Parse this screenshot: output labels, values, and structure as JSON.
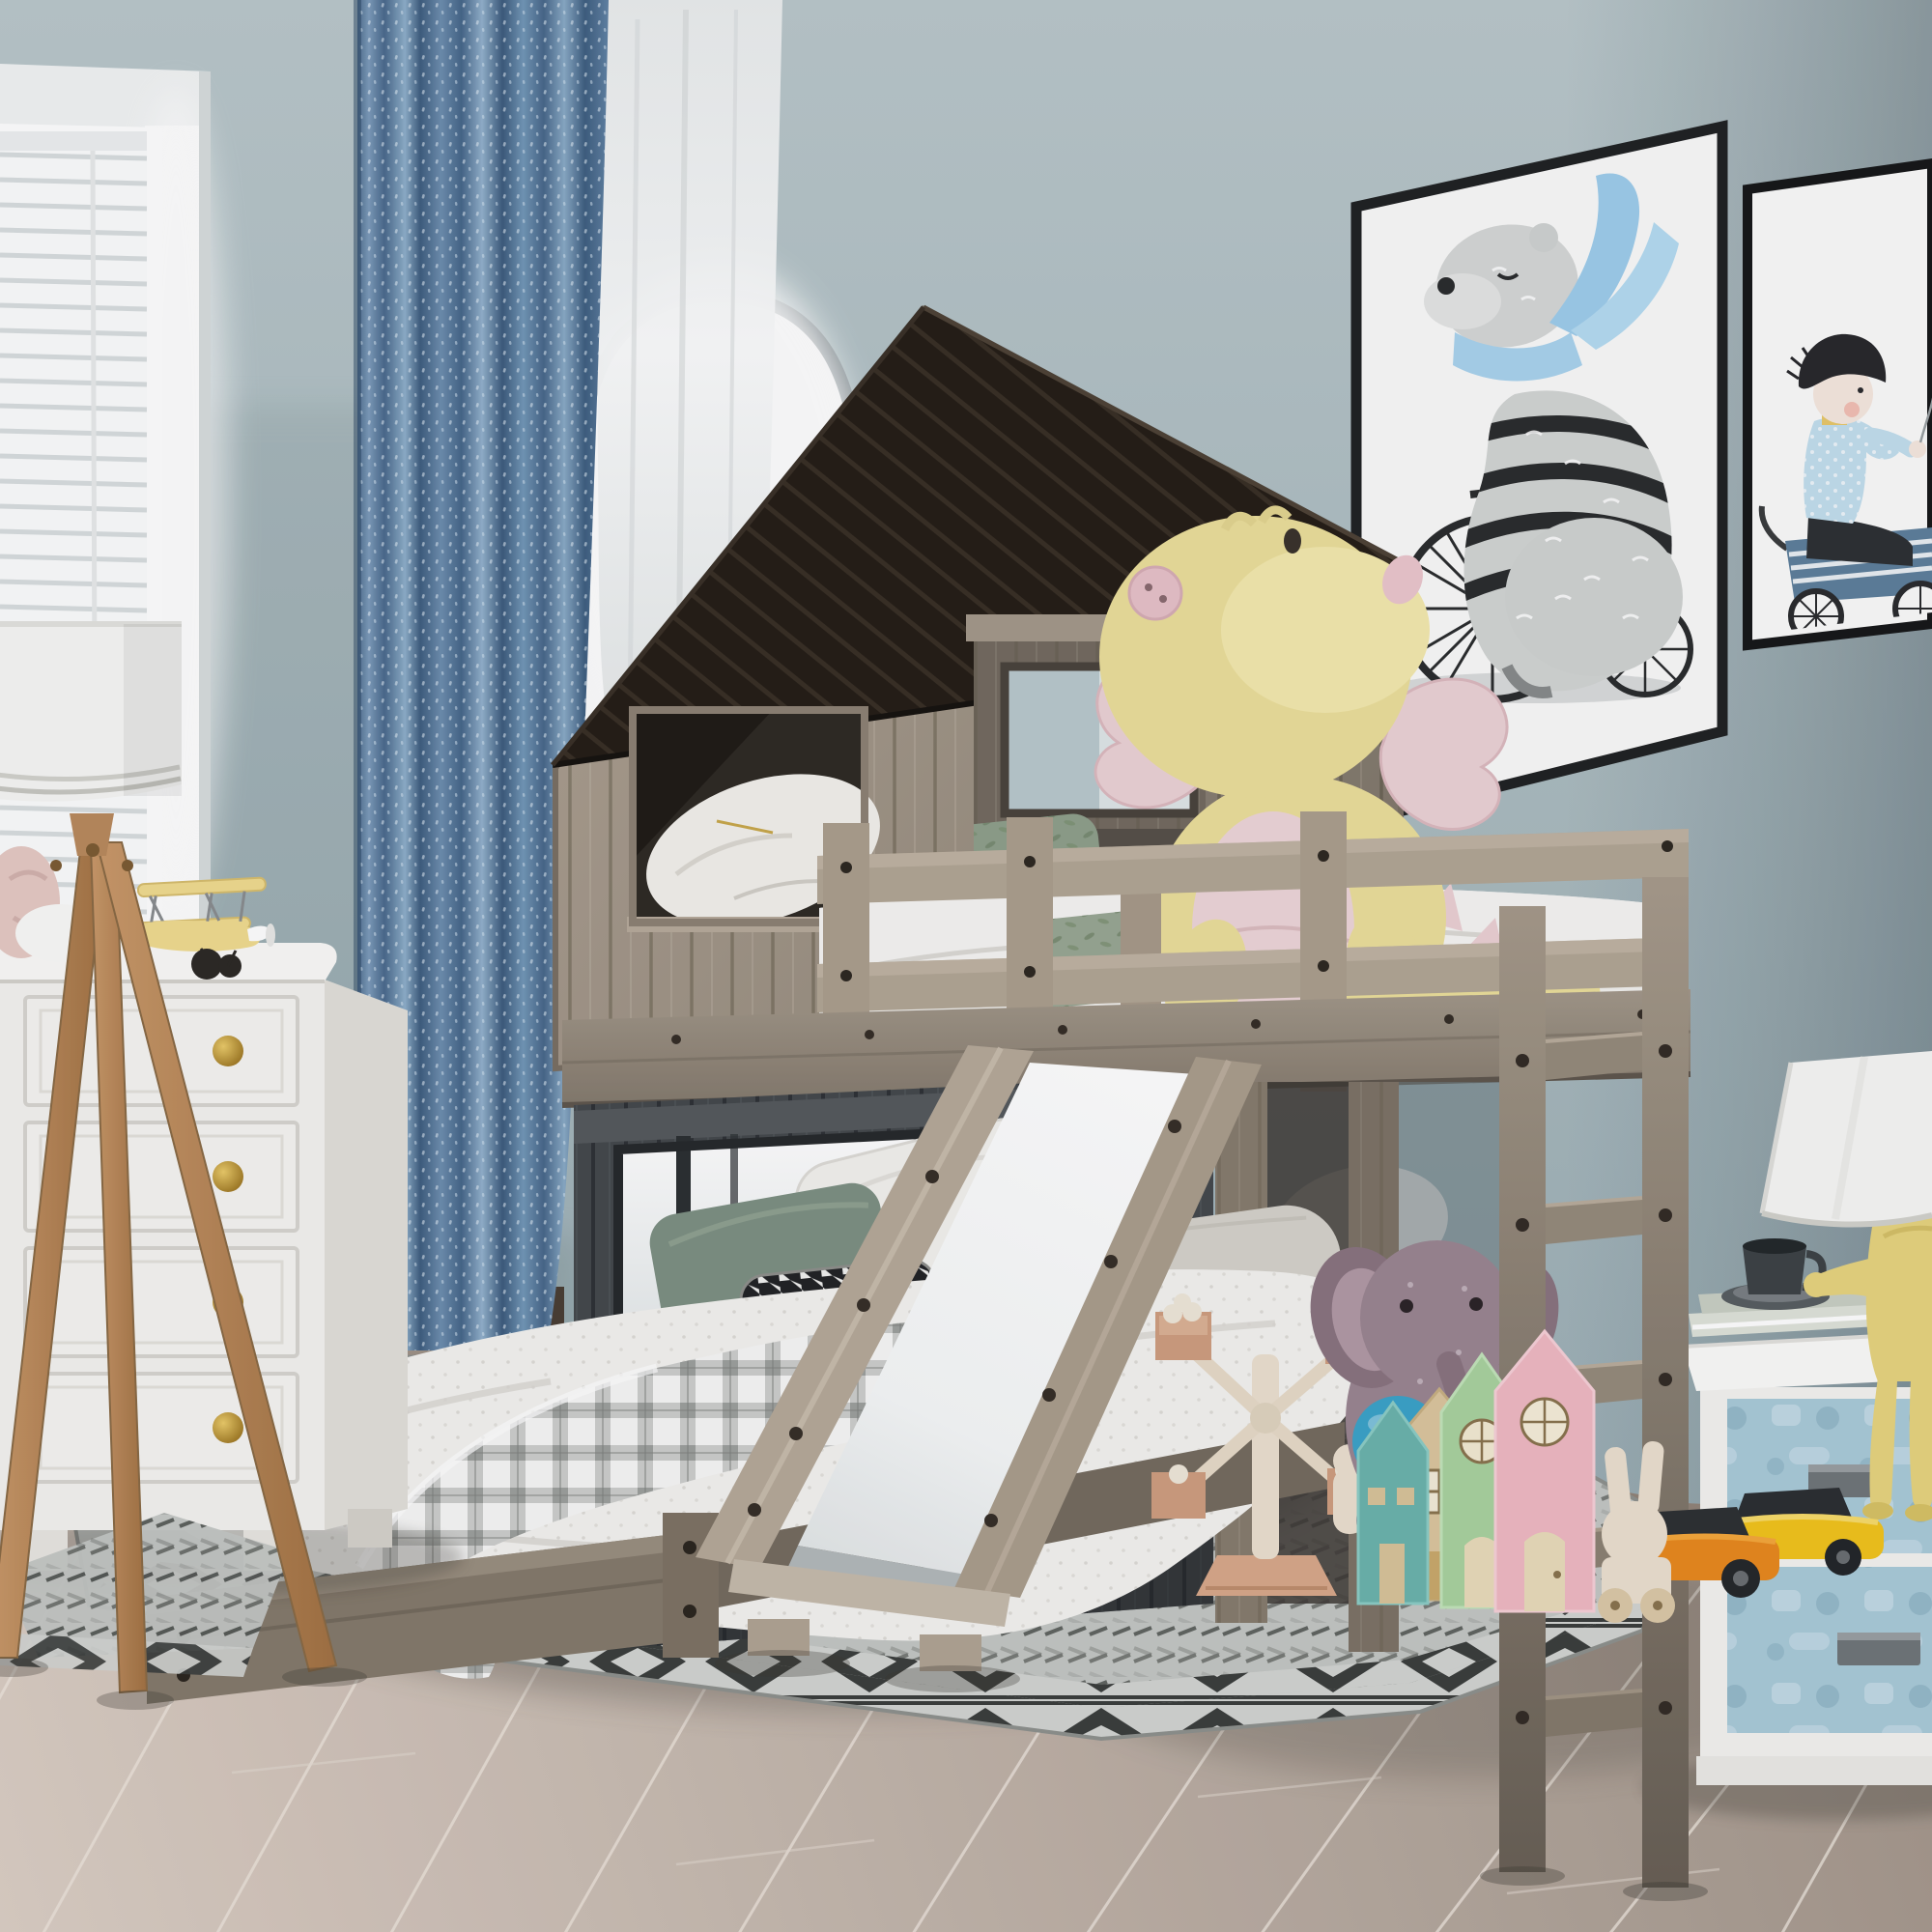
{
  "scene": {
    "description": "3D product photograph of a kids bedroom with a rustic wooden house-shaped bunk loft bed (twin over full) with slide and ladder, surrounded by toys and furniture",
    "room": "children's bedroom",
    "no_visible_text": true
  },
  "palette": {
    "wall_top": "#bac8cb",
    "wall_bottom": "#9cafb5",
    "wall_shadow": "#5a6d77",
    "floor_light": "#dccfc5",
    "floor_dark": "#a2958a",
    "curtain_blue": "#6587a9",
    "curtain_dark": "#3d5c7e",
    "curtain_light": "#93b2cd",
    "sheer_white": "#f4f6f6",
    "frame_black": "#1d1f20",
    "bear_gray": "#d2d5d4",
    "scarf_blue": "#a9d3ee",
    "shirt_blue": "#c3dfee",
    "wagon_blue": "#5e809c",
    "roof_dark": "#251e18",
    "wood_light": "#b0a495",
    "wood_mid": "#9a8e80",
    "wood_dark": "#6e6459",
    "rail_wood": "#b2a695",
    "dark_wall": "#45494d",
    "window_glow": "#ffffff",
    "mattress_white": "#f2f1ee",
    "duvet_white": "#f6f5f3",
    "leaf_green": "#99a794",
    "dragon_yellow": "#ecdf9b",
    "dragon_pink": "#ecd2d6",
    "plaid_gray": "#c9cac8",
    "bolster_gray": "#d5d2cb",
    "pillow_green": "#7d9083",
    "slide_white": "#fdfdfd",
    "dresser_white": "#f4f3f0",
    "knob_gold": "#c99b36",
    "lamp_wood": "#c08f62",
    "shade_white": "#f7f7f5",
    "rug_base": "#c4c7c4",
    "rug_dark": "#3b3e3d",
    "rug_mid": "#9fa29f",
    "nightstand_blue": "#a9cbd9",
    "handle_gray": "#70767a",
    "figure_yellow": "#e7d47f",
    "cup_dark": "#3d4347",
    "elephant_mauve": "#9b8692",
    "ball_blue": "#3ba3c9",
    "house_teal": "#6cb4ad",
    "house_wood": "#dcc69e",
    "house_green": "#a9d29f",
    "house_pink": "#f0b9c3",
    "toy_wood": "#ece0cf",
    "toy_box": "#cf9e80",
    "car_orange": "#e8891f",
    "car_yellow": "#f2c41d",
    "biplane_yellow": "#f1dc90",
    "plush_pink": "#e6cac4"
  },
  "objects": [
    {
      "name": "window-blinds",
      "label": "white venetian blinds window"
    },
    {
      "name": "blue-curtain",
      "label": "speckled blue curtain panel"
    },
    {
      "name": "sheer-curtain-arch",
      "label": "white sheer over arched window"
    },
    {
      "name": "bear-picture",
      "label": "framed print: bear with blue scarf riding bicycle"
    },
    {
      "name": "boy-picture",
      "label": "framed print: boy riding blue wagon"
    },
    {
      "name": "bunk-bed-house",
      "label": "gray wood house-frame loft bed with black roof"
    },
    {
      "name": "slide",
      "label": "wooden slide with white surface"
    },
    {
      "name": "ladder",
      "label": "wooden ladder on right side"
    },
    {
      "name": "dragon-plush",
      "label": "yellow and pink dragon plush on top bunk"
    },
    {
      "name": "lower-bed",
      "label": "full bed with white quilt and gray plaid blanket"
    },
    {
      "name": "dresser",
      "label": "white dresser with gold knobs"
    },
    {
      "name": "biplane-toy",
      "label": "yellow toy biplane on dresser"
    },
    {
      "name": "tripod-lamp",
      "label": "wooden tripod floor lamp with white drum shade"
    },
    {
      "name": "nightstand",
      "label": "white nightstand with blue embossed drawers"
    },
    {
      "name": "figure-lamp",
      "label": "yellow sitting-man lamp with white cone shade"
    },
    {
      "name": "cup-and-books",
      "label": "dark cup on saucer and books on nightstand"
    },
    {
      "name": "rug",
      "label": "gray geometric chevron rug"
    },
    {
      "name": "windmill-toy",
      "label": "wooden ferris-wheel windmill toy with peg dolls"
    },
    {
      "name": "wooden-houses",
      "label": "pastel wooden toy houses (teal, natural, green, pink)"
    },
    {
      "name": "elephant-plush",
      "label": "mauve elephant plush"
    },
    {
      "name": "blue-ball",
      "label": "blue ball"
    },
    {
      "name": "toy-cars",
      "label": "orange and yellow toy cars"
    },
    {
      "name": "rabbit-toy",
      "label": "natural wood rabbit pull toy"
    }
  ]
}
